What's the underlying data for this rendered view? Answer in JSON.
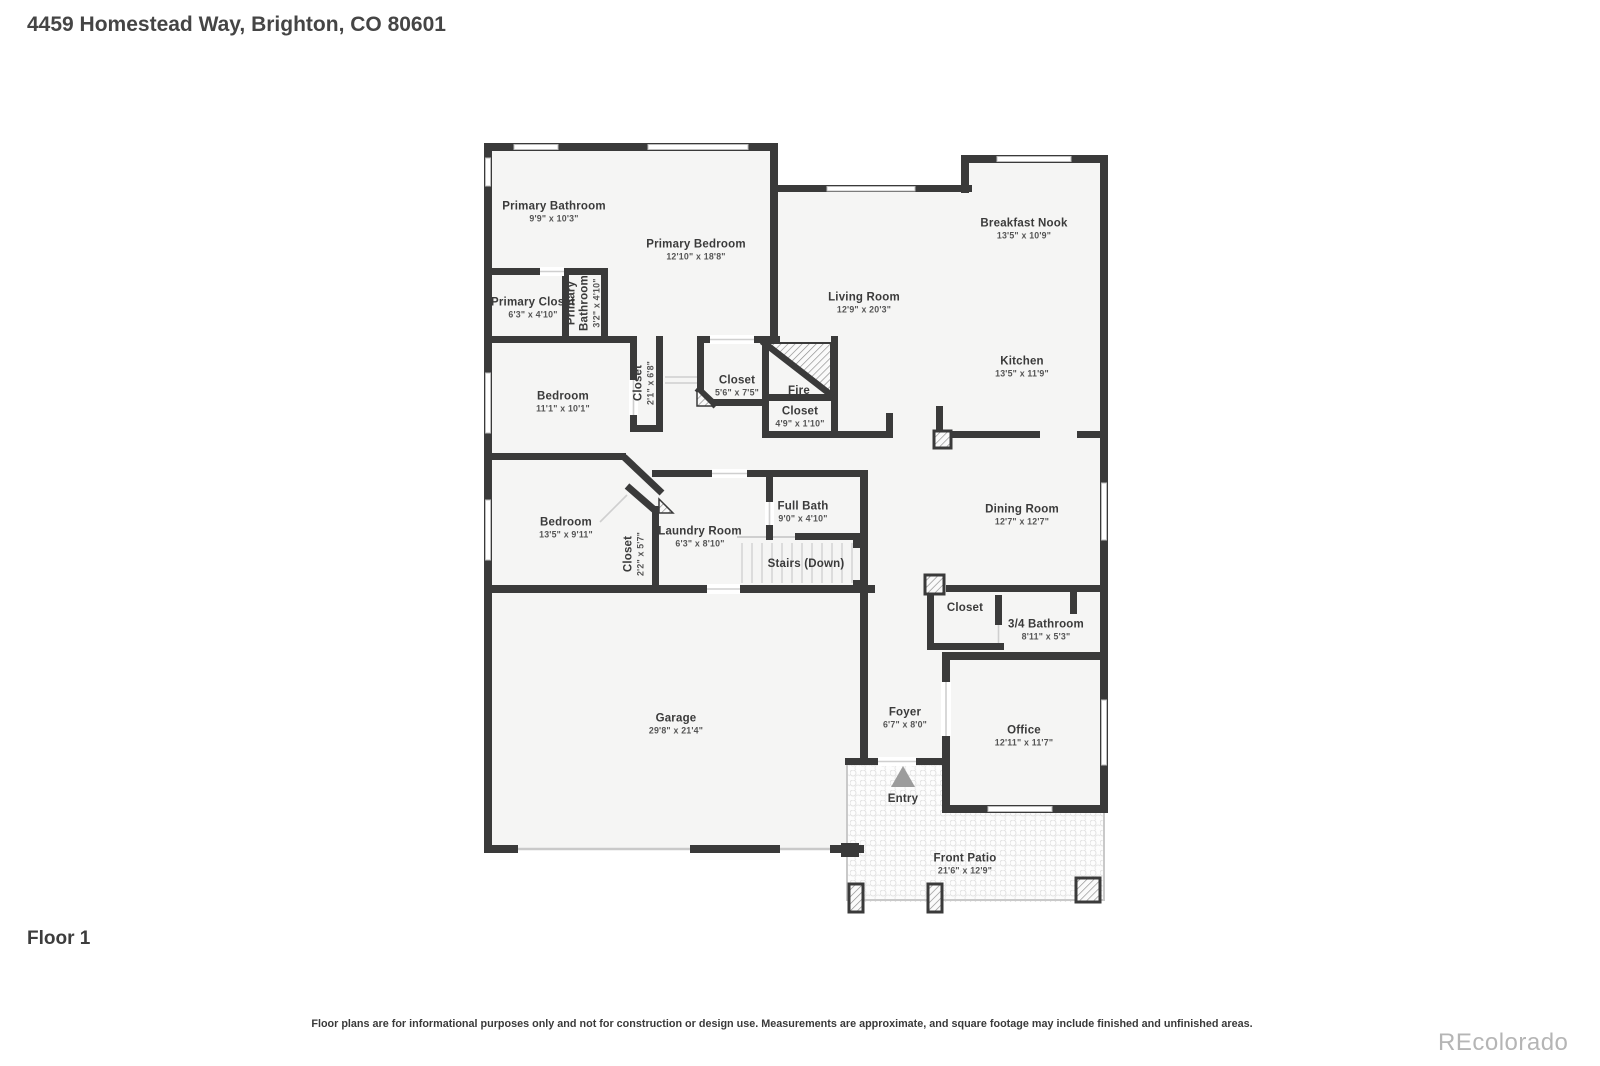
{
  "header": {
    "title": "4459 Homestead Way, Brighton, CO 80601"
  },
  "floor_label": "Floor 1",
  "footer": {
    "disclaimer": "Floor plans are for informational purposes only and not for construction or design use. Measurements are approximate, and square footage may include finished and unfinished areas.",
    "watermark": "REcolorado"
  },
  "colors": {
    "wall": "#3a3a3a",
    "floor": "#f5f5f4",
    "background": "#ffffff",
    "window": "#ffffff",
    "entry_arrow": "#9c9c9c",
    "watermark_gray": "#b5b5b5"
  },
  "rooms": {
    "primary_bathroom": {
      "name": "Primary Bathroom",
      "dims": "9'9\" x 10'3\""
    },
    "primary_bedroom": {
      "name": "Primary Bedroom",
      "dims": "12'10\" x 18'8\""
    },
    "breakfast_nook": {
      "name": "Breakfast Nook",
      "dims": "13'5\" x 10'9\""
    },
    "living_room": {
      "name": "Living Room",
      "dims": "12'9\" x 20'3\""
    },
    "kitchen": {
      "name": "Kitchen",
      "dims": "13'5\" x 11'9\""
    },
    "primary_closet": {
      "name": "Primary Closet",
      "dims": "6'3\" x 4'10\""
    },
    "primary_bathroom_small": {
      "name": "Primary Bathroom",
      "dims": "3'2\" x 4'10\""
    },
    "bedroom_upper": {
      "name": "Bedroom",
      "dims": "11'1\" x 10'1\""
    },
    "hall_closet": {
      "name": "Closet",
      "dims": "2'1\" x 6'8\""
    },
    "closet_main": {
      "name": "Closet",
      "dims": "5'6\" x 7'5\""
    },
    "fireplace": {
      "name": "Fire"
    },
    "closet_small": {
      "name": "Closet",
      "dims": "4'9\" x 1'10\""
    },
    "bedroom_lower": {
      "name": "Bedroom",
      "dims": "13'5\" x 9'11\""
    },
    "bedroom_closet": {
      "name": "Closet",
      "dims": "2'2\" x 5'7\""
    },
    "laundry_room": {
      "name": "Laundry Room",
      "dims": "6'3\" x 8'10\""
    },
    "full_bath": {
      "name": "Full Bath",
      "dims": "9'0\" x 4'10\""
    },
    "stairs": {
      "name": "Stairs (Down)"
    },
    "dining_room": {
      "name": "Dining Room",
      "dims": "12'7\" x 12'7\""
    },
    "entry_closet": {
      "name": "Closet"
    },
    "three_quarter_bath": {
      "name": "3/4 Bathroom",
      "dims": "8'11\" x 5'3\""
    },
    "garage": {
      "name": "Garage",
      "dims": "29'8\" x 21'4\""
    },
    "foyer": {
      "name": "Foyer",
      "dims": "6'7\" x 8'0\""
    },
    "office": {
      "name": "Office",
      "dims": "12'11\" x 11'7\""
    },
    "entry": {
      "name": "Entry"
    },
    "front_patio": {
      "name": "Front Patio",
      "dims": "21'6\" x 12'9\""
    }
  }
}
